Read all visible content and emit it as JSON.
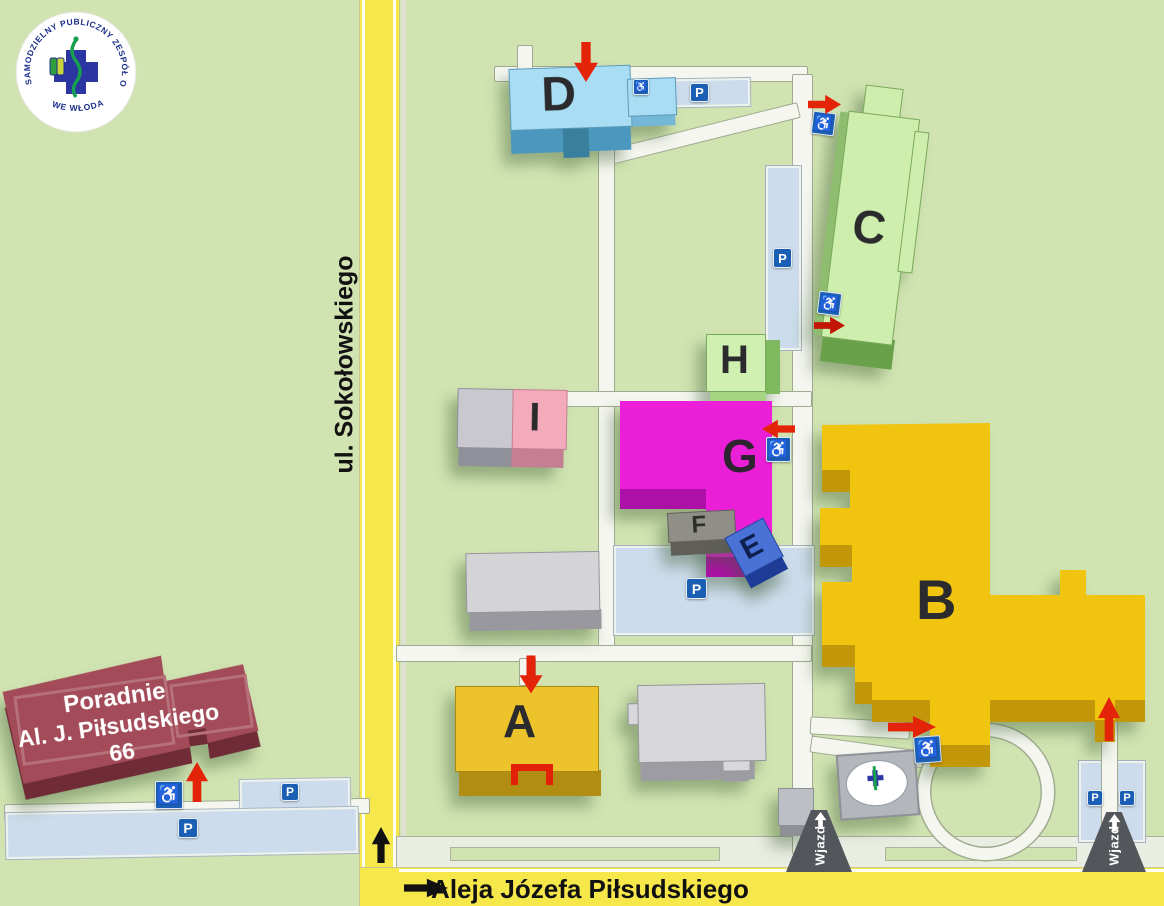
{
  "logo": {
    "ring_text": "SAMODZIELNY PUBLICZNY ZESPÓŁ OPIEKI ZDROWOTNEJ",
    "location_text": "WE WŁODAWIE"
  },
  "streets": {
    "side_street": "ul. Sokołowskiego",
    "main_avenue": "Aleja Józefa Piłsudskiego"
  },
  "buildings": {
    "a": "A",
    "b": "B",
    "c": "C",
    "d": "D",
    "e": "E",
    "f": "F",
    "g": "G",
    "h": "H",
    "i": "I"
  },
  "clinic_sign": {
    "line1": "Poradnie",
    "line2": "Al. J. Piłsudskiego 66"
  },
  "signs": {
    "parking": "P",
    "entrance_road": "Wjazd"
  },
  "icons": {
    "wheelchair": "♿"
  },
  "colors": {
    "map_background": "#d0e3b1",
    "road_yellow": "#f6e74b",
    "road_white": "#f4f6ef",
    "parking_blue": "#ccdcec",
    "sign_blue": "#1b5fb5",
    "arrow_red": "#e32408",
    "building_a": "#edc32b",
    "building_b": "#f1c50f",
    "building_c": "#ceeeae",
    "building_d": "#a9ddf3",
    "building_e": "#4a72d6",
    "building_f": "#8f8e87",
    "building_g": "#ec1fd9",
    "building_h": "#cff0b0",
    "building_i_pink": "#f3abbc",
    "building_i_gray": "#c8c8ce",
    "clinic_red": "#a34b58"
  }
}
